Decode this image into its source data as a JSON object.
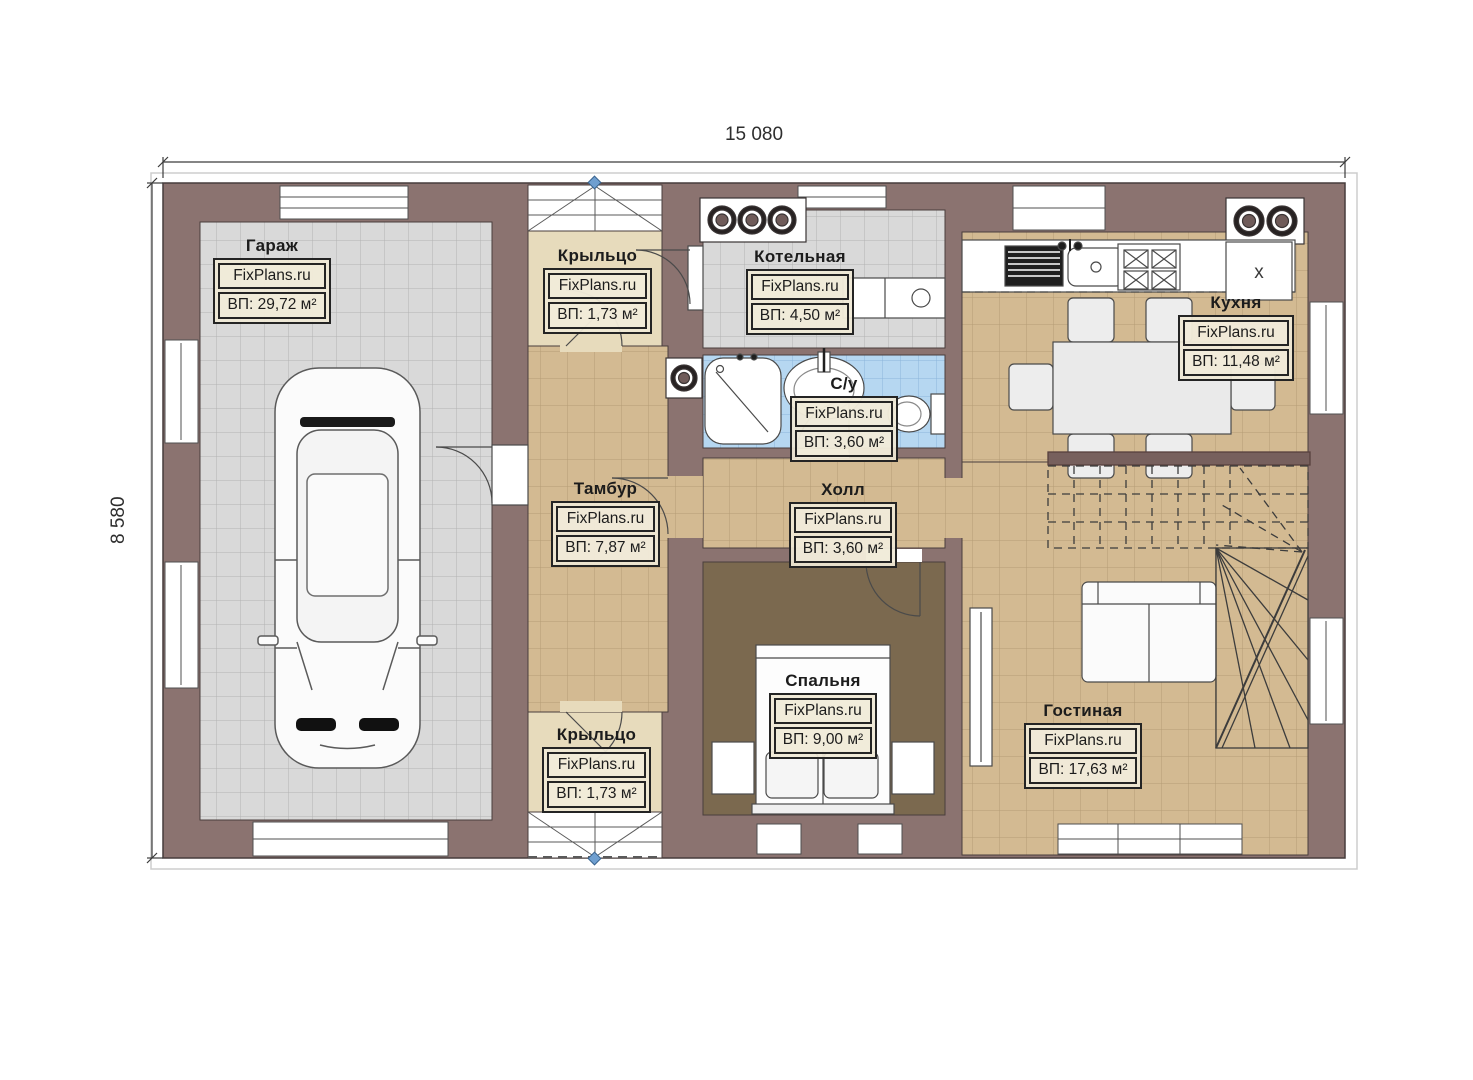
{
  "dimensions": {
    "top": "15 080",
    "left": "8 580"
  },
  "watermark": "FixPlans.ru",
  "icons": {
    "fridge_mark": "x"
  },
  "palette": {
    "wall": "#8b7370",
    "garage_tile": "#d9d9d9",
    "beige_tile": "#d3ba92",
    "bath_tile": "#b6d7f1",
    "bedroom_floor": "#7b694f",
    "porch_landing": "#e7dbbc",
    "label_bg": "#efe8d5",
    "marker_blue": "#6f9fd0"
  },
  "rooms": [
    {
      "id": "garage",
      "name": "Гараж",
      "site": "FixPlans.ru",
      "area": "ВП: 29,72 м²"
    },
    {
      "id": "porch-top",
      "name": "Крыльцо",
      "site": "FixPlans.ru",
      "area": "ВП: 1,73 м²"
    },
    {
      "id": "boiler",
      "name": "Котельная",
      "site": "FixPlans.ru",
      "area": "ВП: 4,50 м²"
    },
    {
      "id": "kitchen",
      "name": "Кухня",
      "site": "FixPlans.ru",
      "area": "ВП: 11,48 м²"
    },
    {
      "id": "bathroom",
      "name": "С/у",
      "site": "FixPlans.ru",
      "area": "ВП: 3,60 м²"
    },
    {
      "id": "vestibule",
      "name": "Тамбур",
      "site": "FixPlans.ru",
      "area": "ВП: 7,87 м²"
    },
    {
      "id": "hall",
      "name": "Холл",
      "site": "FixPlans.ru",
      "area": "ВП: 3,60 м²"
    },
    {
      "id": "bedroom",
      "name": "Спальня",
      "site": "FixPlans.ru",
      "area": "ВП: 9,00 м²"
    },
    {
      "id": "living",
      "name": "Гостиная",
      "site": "FixPlans.ru",
      "area": "ВП: 17,63 м²"
    },
    {
      "id": "porch-bottom",
      "name": "Крыльцо",
      "site": "FixPlans.ru",
      "area": "ВП: 1,73 м²"
    }
  ]
}
